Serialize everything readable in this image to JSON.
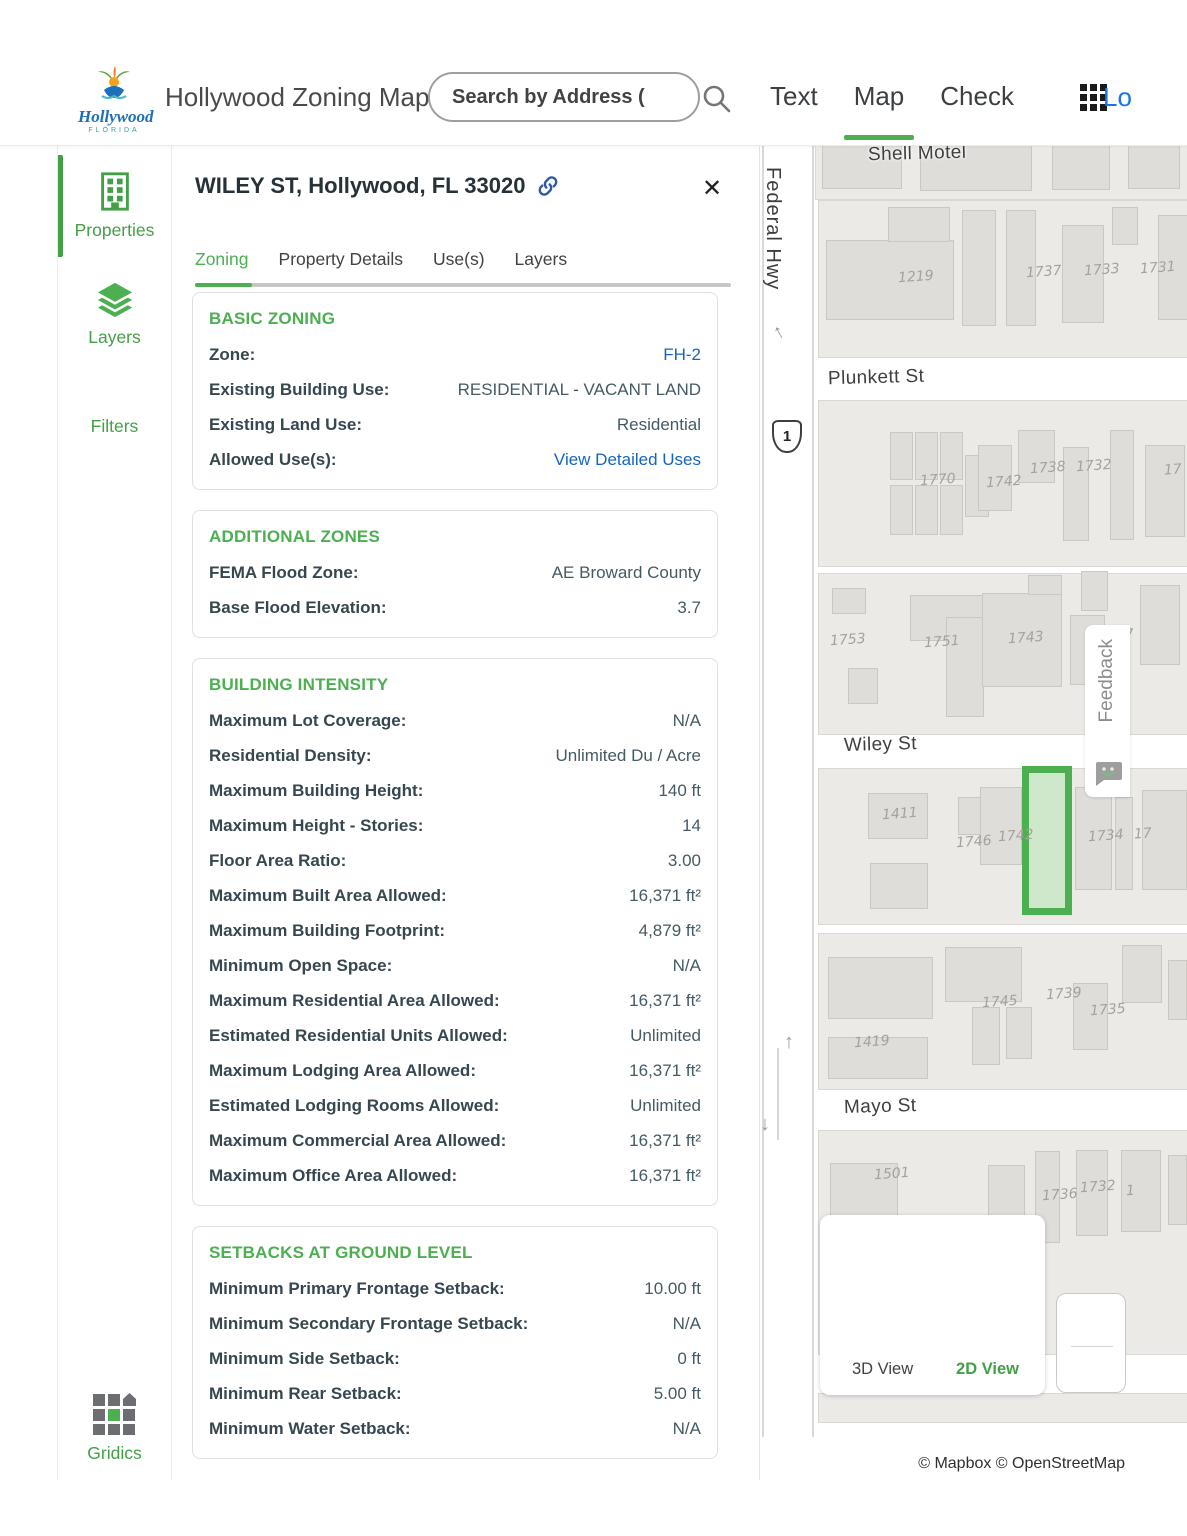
{
  "header": {
    "logo_title": "Hollywood",
    "logo_subtitle": "FLORIDA",
    "app_title": "Hollywood Zoning Map",
    "search_placeholder": "Search by Address (",
    "nav": [
      {
        "label": "Text",
        "active": false
      },
      {
        "label": "Map",
        "active": true
      },
      {
        "label": "Check",
        "active": false
      }
    ],
    "login_label": "Lo"
  },
  "sidebar": {
    "items": [
      {
        "label": "Properties",
        "icon": "building-icon",
        "active": true
      },
      {
        "label": "Layers",
        "icon": "layers-icon",
        "active": false
      },
      {
        "label": "Filters",
        "icon": "none",
        "active": false
      },
      {
        "label": "Gridics",
        "icon": "gridics-logo",
        "active": false
      }
    ]
  },
  "panel": {
    "title": "WILEY ST, Hollywood, FL 33020",
    "close_label": "✕",
    "tabs": [
      {
        "label": "Zoning",
        "active": true
      },
      {
        "label": "Property Details",
        "active": false
      },
      {
        "label": "Use(s)",
        "active": false
      },
      {
        "label": "Layers",
        "active": false
      }
    ],
    "sections": [
      {
        "heading": "BASIC ZONING",
        "rows": [
          {
            "label": "Zone:",
            "value": "FH-2",
            "link": true
          },
          {
            "label": "Existing Building Use:",
            "value": "RESIDENTIAL - VACANT LAND",
            "link": false
          },
          {
            "label": "Existing Land Use:",
            "value": "Residential",
            "link": false
          },
          {
            "label": "Allowed Use(s):",
            "value": "View Detailed Uses",
            "link": true
          }
        ]
      },
      {
        "heading": "ADDITIONAL ZONES",
        "rows": [
          {
            "label": "FEMA Flood Zone:",
            "value": "AE Broward County",
            "link": false
          },
          {
            "label": "Base Flood Elevation:",
            "value": "3.7",
            "link": false
          }
        ]
      },
      {
        "heading": "BUILDING INTENSITY",
        "rows": [
          {
            "label": "Maximum Lot Coverage:",
            "value": "N/A",
            "link": false
          },
          {
            "label": "Residential Density:",
            "value": "Unlimited Du / Acre",
            "link": false
          },
          {
            "label": "Maximum Building Height:",
            "value": "140 ft",
            "link": false
          },
          {
            "label": "Maximum Height - Stories:",
            "value": "14",
            "link": false
          },
          {
            "label": "Floor Area Ratio:",
            "value": "3.00",
            "link": false
          },
          {
            "label": "Maximum Built Area Allowed:",
            "value": "16,371 ft²",
            "link": false
          },
          {
            "label": "Maximum Building Footprint:",
            "value": "4,879 ft²",
            "link": false
          },
          {
            "label": "Minimum Open Space:",
            "value": "N/A",
            "link": false
          },
          {
            "label": "Maximum Residential Area Allowed:",
            "value": "16,371 ft²",
            "link": false
          },
          {
            "label": "Estimated Residential Units Allowed:",
            "value": "Unlimited",
            "link": false
          },
          {
            "label": "Maximum Lodging Area Allowed:",
            "value": "16,371 ft²",
            "link": false
          },
          {
            "label": "Estimated Lodging Rooms Allowed:",
            "value": "Unlimited",
            "link": false
          },
          {
            "label": "Maximum Commercial Area Allowed:",
            "value": "16,371 ft²",
            "link": false
          },
          {
            "label": "Maximum Office Area Allowed:",
            "value": "16,371 ft²",
            "link": false
          }
        ]
      },
      {
        "heading": "SETBACKS AT GROUND LEVEL",
        "rows": [
          {
            "label": "Minimum Primary Frontage Setback:",
            "value": "10.00 ft",
            "link": false
          },
          {
            "label": "Minimum Secondary Frontage Setback:",
            "value": "N/A",
            "link": false
          },
          {
            "label": "Minimum Side Setback:",
            "value": "0 ft",
            "link": false
          },
          {
            "label": "Minimum Rear Setback:",
            "value": "5.00 ft",
            "link": false
          },
          {
            "label": "Minimum Water Setback:",
            "value": "N/A",
            "link": false
          }
        ]
      }
    ]
  },
  "map": {
    "route_shield": "1",
    "street_labels": [
      {
        "text": "Federal Hwy",
        "x": 1,
        "y": 22,
        "vertical": true
      },
      {
        "text": "Shell Motel",
        "x": 108,
        "y": -2,
        "vertical": false
      },
      {
        "text": "Plunkett St",
        "x": 68,
        "y": 222,
        "vertical": false
      },
      {
        "text": "Wiley St",
        "x": 84,
        "y": 589,
        "vertical": false
      },
      {
        "text": "Mayo St",
        "x": 84,
        "y": 951,
        "vertical": false
      }
    ],
    "parcel_labels": [
      {
        "text": "1219",
        "x": 138,
        "y": 124
      },
      {
        "text": "1737",
        "x": 266,
        "y": 119
      },
      {
        "text": "1733",
        "x": 324,
        "y": 117
      },
      {
        "text": "1731",
        "x": 380,
        "y": 115
      },
      {
        "text": "1770",
        "x": 160,
        "y": 327
      },
      {
        "text": "1742",
        "x": 226,
        "y": 329
      },
      {
        "text": "1738",
        "x": 270,
        "y": 315
      },
      {
        "text": "1732",
        "x": 316,
        "y": 313
      },
      {
        "text": "17",
        "x": 404,
        "y": 317
      },
      {
        "text": "1753",
        "x": 70,
        "y": 487
      },
      {
        "text": "1751",
        "x": 164,
        "y": 489
      },
      {
        "text": "1743",
        "x": 248,
        "y": 485
      },
      {
        "text": "17",
        "x": 356,
        "y": 482
      },
      {
        "text": "1411",
        "x": 122,
        "y": 661
      },
      {
        "text": "1746",
        "x": 196,
        "y": 689
      },
      {
        "text": "1742",
        "x": 238,
        "y": 683
      },
      {
        "text": "1734",
        "x": 328,
        "y": 683
      },
      {
        "text": "17",
        "x": 374,
        "y": 681
      },
      {
        "text": "1419",
        "x": 94,
        "y": 889
      },
      {
        "text": "1745",
        "x": 222,
        "y": 849
      },
      {
        "text": "1739",
        "x": 286,
        "y": 841
      },
      {
        "text": "1735",
        "x": 330,
        "y": 857
      },
      {
        "text": "1501",
        "x": 114,
        "y": 1021
      },
      {
        "text": "1736",
        "x": 282,
        "y": 1042
      },
      {
        "text": "1732",
        "x": 320,
        "y": 1034
      },
      {
        "text": "1",
        "x": 366,
        "y": 1038
      }
    ],
    "feedback_label": "Feedback",
    "view_controls": {
      "view_3d": "3D View",
      "view_2d": "2D View",
      "active": "2D View"
    },
    "attribution": "© Mapbox © OpenStreetMap"
  },
  "colors": {
    "accent_green": "#4CAF50",
    "sidebar_green": "#43A047",
    "link_blue": "#1565C0",
    "login_blue": "#1a73e8",
    "selected_parcel_fill": "#CFE7CB",
    "selected_parcel_border": "#4CAF50"
  }
}
